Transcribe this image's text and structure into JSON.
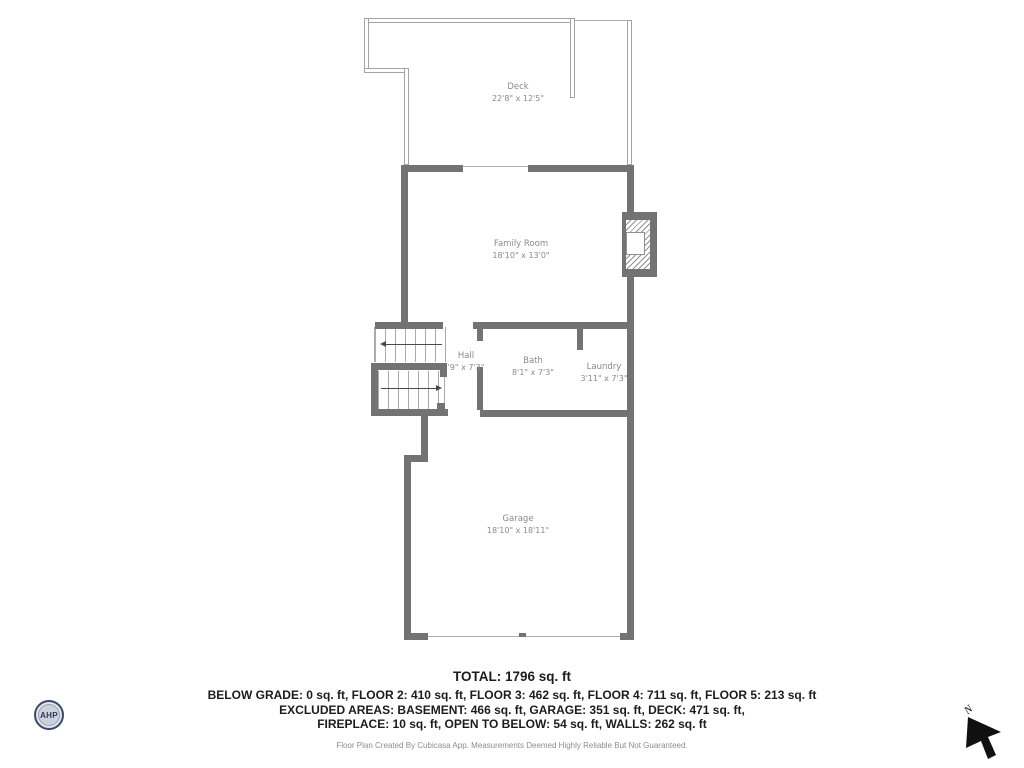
{
  "plan": {
    "rooms": [
      {
        "id": "deck",
        "name": "Deck",
        "dims": "22'8\" x 12'5\""
      },
      {
        "id": "family_room",
        "name": "Family Room",
        "dims": "18'10\" x 13'0\""
      },
      {
        "id": "hall",
        "name": "Hall",
        "dims": "'9\" x 7'3\""
      },
      {
        "id": "bath",
        "name": "Bath",
        "dims": "8'1\" x 7'3\""
      },
      {
        "id": "laundry",
        "name": "Laundry",
        "dims": "3'11\" x 7'3\""
      },
      {
        "id": "garage",
        "name": "Garage",
        "dims": "18'10\" x 18'11\""
      }
    ]
  },
  "summary": {
    "total": "TOTAL: 1796 sq. ft",
    "line1": "BELOW GRADE: 0 sq. ft, FLOOR 2: 410 sq. ft, FLOOR 3: 462 sq. ft, FLOOR 4: 711 sq. ft, FLOOR 5: 213 sq. ft",
    "line2": "EXCLUDED AREAS: BASEMENT: 466 sq. ft, GARAGE: 351 sq. ft, DECK: 471 sq. ft,",
    "line3": "FIREPLACE: 10 sq. ft, OPEN TO BELOW: 54 sq. ft, WALLS: 262 sq. ft",
    "disclaimer": "Floor Plan Created By Cubicasa App. Measurements Deemed Highly Reliable But Not Guaranteed."
  },
  "logo": {
    "text": "AHP"
  },
  "compass": {
    "label": "N"
  },
  "colors": {
    "wall": "#737373",
    "railing": "#a3a3a3",
    "room_label": "#8a8a8a",
    "summary_text": "#1c1c1c",
    "logo_navy": "#3c4a66"
  }
}
